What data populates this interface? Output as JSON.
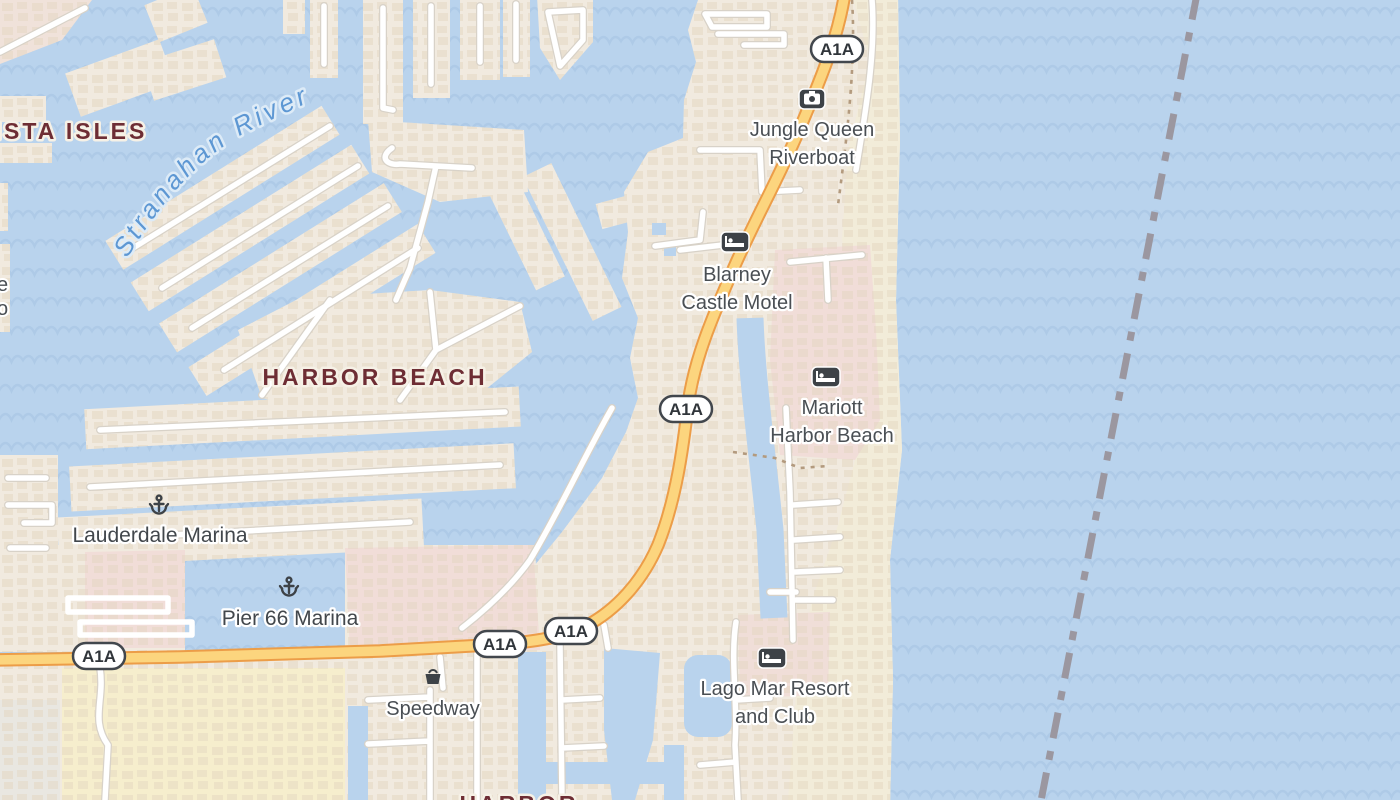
{
  "map": {
    "shield_label": "A1A",
    "river_label": "Stranahan River",
    "neighborhoods": {
      "vista_isles": "ISTA ISLES",
      "harbor_beach": "HARBOR BEACH",
      "bottom_partial": "HARBOR"
    },
    "fragments": {
      "f1": "e",
      "f2": "o"
    },
    "pois": {
      "jungle_queen": {
        "line1": "Jungle Queen",
        "line2": "Riverboat",
        "icon": "camera-icon"
      },
      "blarney": {
        "line1": "Blarney",
        "line2": "Castle Motel",
        "icon": "bed-icon"
      },
      "mariott": {
        "line1": "Mariott",
        "line2": "Harbor Beach",
        "icon": "bed-icon"
      },
      "lago_mar": {
        "line1": "Lago Mar Resort",
        "line2": "and Club",
        "icon": "bed-icon"
      },
      "lauderdale_marina": {
        "label": "Lauderdale Marina",
        "icon": "anchor-icon"
      },
      "pier_66": {
        "label": "Pier 66 Marina",
        "icon": "anchor-icon"
      },
      "speedway": {
        "label": "Speedway",
        "icon": "basket-icon"
      }
    },
    "colors": {
      "water": "#b9d3ed",
      "wave": "#aac7e4",
      "land": "#f1eadf",
      "sand": "#f2ecd9",
      "resort_pink": "#f1ddd8",
      "commercial_yellow": "#f6eecd",
      "gray_block": "#e9e7e1",
      "road_minor": "#ffffff",
      "road_minor_casing": "#d8d2c8",
      "highway_fill": "#fcd57e",
      "highway_casing": "#ec9d48",
      "boundary_dash": "#9b97a0",
      "label_dark": "#4a4f54",
      "label_maroon": "#6e2d34",
      "label_river_blue": "#5d97d3",
      "icon_badge": "#3d4247"
    }
  }
}
